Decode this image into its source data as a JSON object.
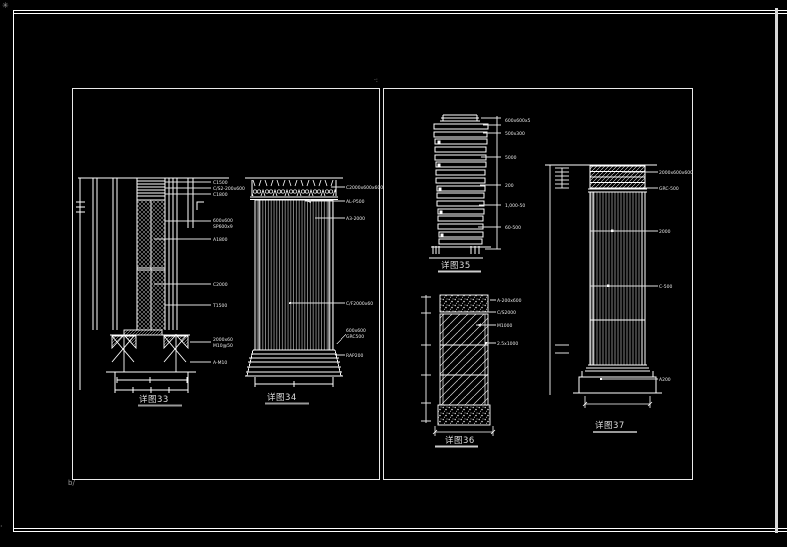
{
  "sheet": {
    "background": "#000000",
    "line_color": "#ffffff",
    "marks": {
      "corner": "✳",
      "bottom_left": "·",
      "below_left_panel": "b/",
      "panel_top": "·:"
    }
  },
  "d33": {
    "caption": "详图33",
    "labels": [
      "C1500",
      "C/S2-200x600",
      "C1800",
      "600x600",
      "SP600x9",
      "A1800",
      "C2000",
      "T1500",
      "2000x60",
      "M10@50",
      "A-M10"
    ]
  },
  "d34": {
    "caption": "详图34",
    "labels": [
      "C2000x600x600",
      "AL-P500",
      "A3-2000",
      "C/F2000x60",
      "600x600",
      "GRC500",
      "RAP200"
    ]
  },
  "d35": {
    "caption": "详图35",
    "labels": [
      "600x600x5",
      "500x300",
      "5000",
      "200",
      "1,000-50",
      "60-500"
    ]
  },
  "d36": {
    "caption": "详图36",
    "labels": [
      "A-200x600",
      "C/S2000",
      "M1000",
      "2.5x1000"
    ]
  },
  "d37": {
    "caption": "详图37",
    "labels": [
      "2000x600x600",
      "GRC-500",
      "2000",
      "C-500",
      "A200"
    ]
  }
}
